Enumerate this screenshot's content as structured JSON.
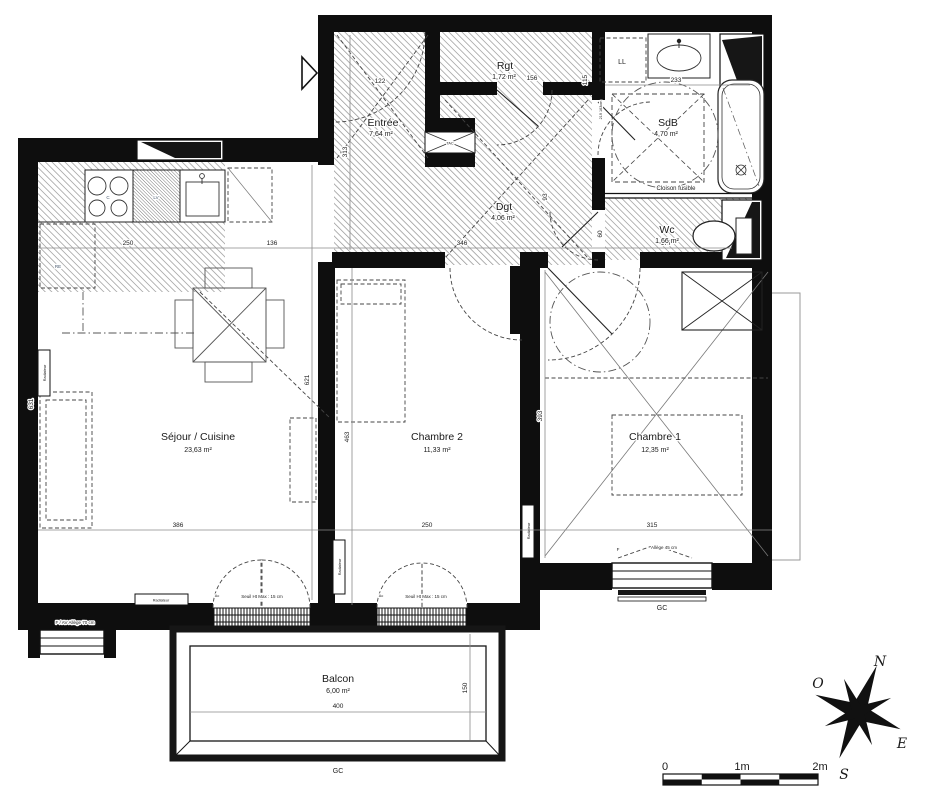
{
  "rooms": {
    "entree": {
      "name": "Entrée",
      "area": "7,64 m²"
    },
    "rgt": {
      "name": "Rgt",
      "area": "1,72 m²"
    },
    "sdb": {
      "name": "SdB",
      "area": "4,70 m²"
    },
    "wc": {
      "name": "Wc",
      "area": "1,66 m²"
    },
    "dgt": {
      "name": "Dgt",
      "area": "4,06 m²"
    },
    "sejour": {
      "name": "Séjour / Cuisine",
      "area": "23,63 m²"
    },
    "chambre2": {
      "name": "Chambre 2",
      "area": "11,33 m²"
    },
    "chambre1": {
      "name": "Chambre 1",
      "area": "12,35 m²"
    },
    "balcon": {
      "name": "Balcon",
      "area": "6,00 m²"
    }
  },
  "labels": {
    "cloison": "Cloison fusible",
    "ll": "LL",
    "lv": "LV",
    "c": "C",
    "re": "RE",
    "tac": "TAC",
    "radiateur": "Radiateur",
    "seuil": "Seuil Ht Max : 15 cm",
    "ac": "Ac",
    "allege45": "Allège 45 cm",
    "f": "F",
    "fav": "F / AV Allège 70 cm",
    "gc": "GC"
  },
  "dimensions": {
    "entry_top": "122",
    "entry_h": "313",
    "kitchen_w": "250",
    "gap": "136",
    "entry_w": "346",
    "wc_w": "177",
    "sdb_w": "233",
    "rgt_w": "156",
    "rgt_h": "115",
    "door_h": "93",
    "wc_h": "60",
    "niche": "219 163cm",
    "sejour_w": "386",
    "ch2_w": "250",
    "ch1_w": "315",
    "sejour_h": "621",
    "left_h": "631",
    "ch2_h": "463",
    "ch1_h": "393",
    "balcon_w": "400",
    "balcon_d": "150"
  },
  "compass": {
    "n": "N",
    "e": "E",
    "s": "S",
    "o": "O"
  },
  "scalebar": {
    "t0": "0",
    "t1": "1m",
    "t2": "2m"
  },
  "colors": {
    "wall": "#0e0e0e",
    "hatch": "#9a9a9a",
    "appliance_label": "#44566b"
  }
}
